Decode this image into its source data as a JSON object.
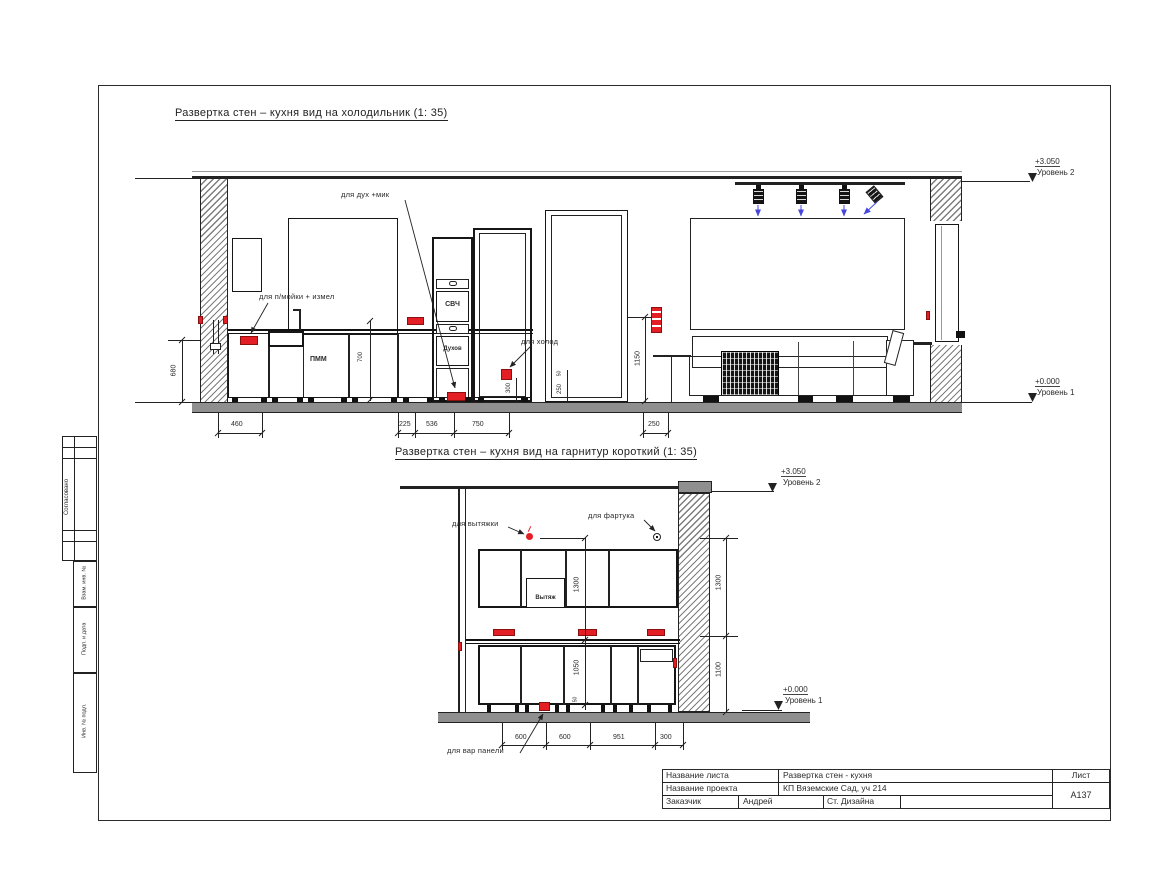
{
  "colors": {
    "red": "#e31e24",
    "blue": "#4646dc",
    "line": "#222222",
    "floor_gray": "#8f8f8f"
  },
  "levels": {
    "l2_value": "+3.050",
    "l2_name": "Уровень 2",
    "l1_value": "+0.000",
    "l1_name": "Уровень 1"
  },
  "view1": {
    "title": "Развертка стен – кухня вид на холодильник (1: 35)",
    "labels": {
      "oven_mic": "для дух +мик",
      "sink": "для п/мойки + измел",
      "fridge": "для холод",
      "microwave": "СВЧ",
      "oven": "Духов",
      "dishwasher": "ПММ"
    },
    "dims": {
      "w460": "460",
      "w225": "225",
      "w536": "536",
      "w750": "750",
      "w250": "250",
      "h680": "680",
      "h1150": "1150",
      "h700": "700",
      "h300": "300",
      "h250": "250",
      "h50": "50"
    }
  },
  "view2": {
    "title": "Развертка стен – кухня вид на гарнитур короткий (1: 35)",
    "labels": {
      "hood_socket": "для вытяжки",
      "apron": "для фартука",
      "hood": "Вытяж",
      "hob": "для вар панели"
    },
    "dims": {
      "w600a": "600",
      "w600b": "600",
      "w951": "951",
      "w300": "300",
      "m1300": "1300",
      "m1050": "1050",
      "m50": "50",
      "r1300": "1300",
      "r1100": "1100"
    }
  },
  "stamp": {
    "sheet_name_label": "Название листа",
    "sheet_name": "Развертка стен - кухня",
    "project_label": "Название проекта",
    "project": "КП Вяземские Сад, уч 214",
    "client_label": "Заказчик",
    "client": "Андрей",
    "studio": "Ст. Дизайна",
    "sheet_label": "Лист",
    "sheet_no": "А137"
  },
  "margin": {
    "approved": "Согласовано",
    "vzam": "Взам. инв. №",
    "podp": "Подп. и дата",
    "inv": "Инв. № подл."
  }
}
